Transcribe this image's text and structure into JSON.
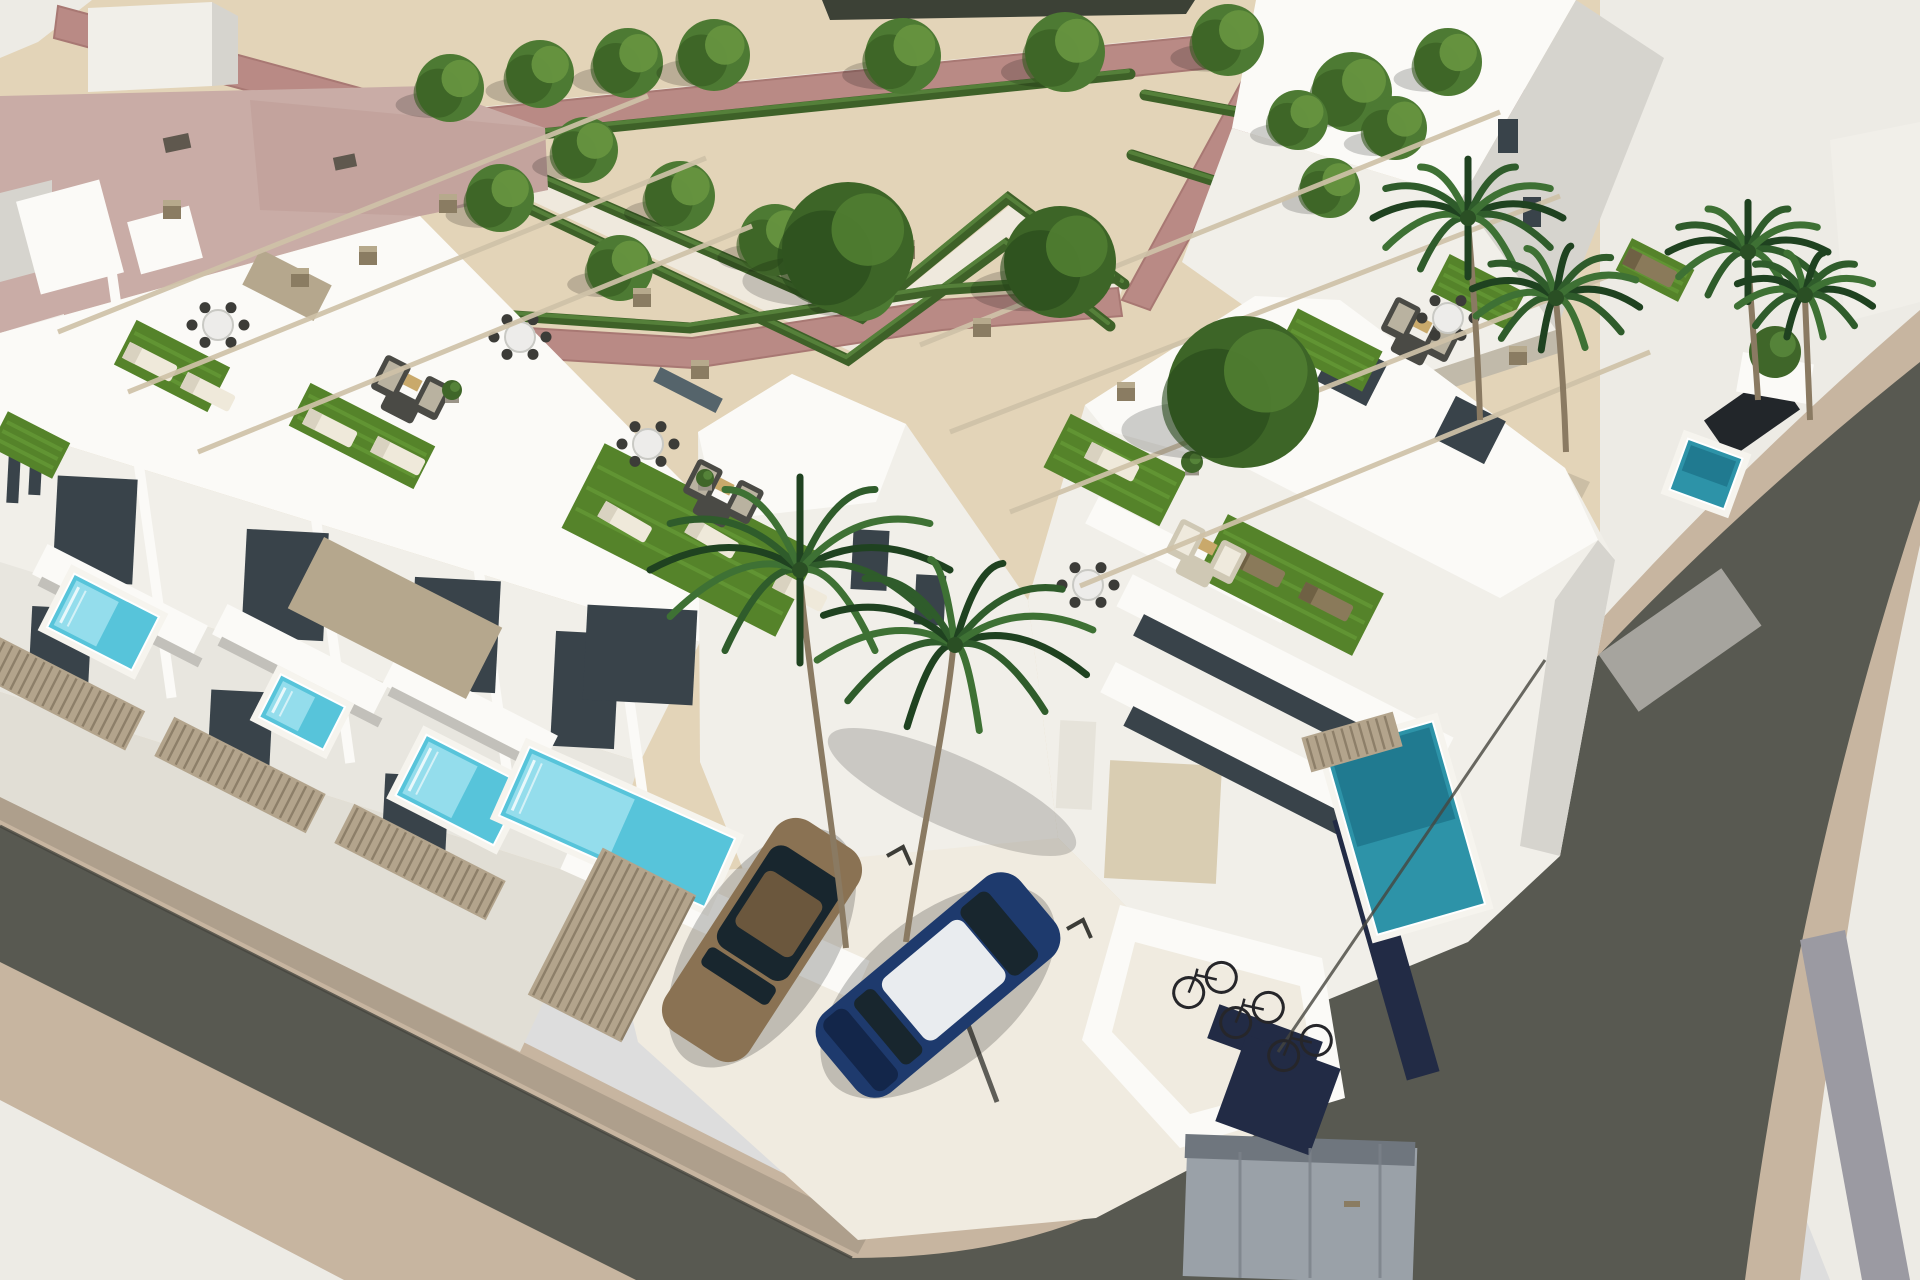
{
  "image": {
    "type": "3d-architectural-render",
    "subject": "aerial view of modern white terraced houses with rooftop terraces, private plunge pools, pergolas, a formal hedge park, corner streets, parked cars, palms and a bicycle shelter"
  },
  "palette": {
    "sand": "#e3d4b8",
    "pavement": "#edebe5",
    "pavement_warm": "#f0ebe0",
    "tan": "#c7b5a0",
    "asphalt": "#585951",
    "mauve": "#b98a85",
    "mauve2": "#a87873",
    "hedge": "#3e6128",
    "hedge_hi": "#55803a",
    "walk": "#efe9dd",
    "white_wall": "#f1efe9",
    "white_bright": "#fbfaf7",
    "band3": "#e8e6df",
    "band4": "#e1ded5",
    "wall_shade": "#d6d4ce",
    "wall_mid": "#c2c0ba",
    "wall_dark": "#a6a49e",
    "glass": "#39434a",
    "glass2": "#55646b",
    "stone": "#b5a78d",
    "beam": "#cfc2a8",
    "cap": "#8a7c62",
    "cap_top": "#b6a98c",
    "fence": "#b3a48c",
    "fence_slat": "#8d7f69",
    "turf": "#55832a",
    "turf2": "#6aa039",
    "pool_rim": "#f6f4ee",
    "pool_light": "#9fe2ee",
    "pool_mid": "#57c4da",
    "pool_teal": "#2d93a8",
    "pool_deep": "#1d7489",
    "trunk": "#8a7a62",
    "tree": "#4d7a33",
    "tree_d": "#35591f",
    "tree_l": "#66933f",
    "btree": "#3d6527",
    "btree_d": "#27481a",
    "btree_l": "#4f7c30",
    "palm1": "#1f4220",
    "palm2": "#2f5c2b",
    "palm3": "#3e7134",
    "car_gold": "#8a7253",
    "car_gold2": "#6b573d",
    "car_blue": "#1e3a6d",
    "car_blue2": "#13264a",
    "car_roof": "#e9ecef",
    "car_glass": "#18262e",
    "car_dark": "#22262a",
    "bike": "#26262a",
    "furn": "#4a4a45",
    "furn_c": "#d9d2bf",
    "cabinet": "#9aa1a8",
    "cabinet2": "#6f767e",
    "navy": "#222b45",
    "median": "#9b9aa2",
    "distant": "#3c4136",
    "door_beige": "#d9cdb2",
    "door_white": "#e6e3da",
    "vent": "#5f584e",
    "roof_pink": "#c9aca6",
    "roof_pink2": "#bd9c95"
  },
  "park": {
    "walkways": [
      "470,108 1265,28 1272,52 478,136",
      "470,140 862,325 1010,205 1122,290 1112,318 1008,237 852,352 458,166"
    ],
    "mauve_paths": [
      "58,6 448,112 452,146 54,38",
      "448,112 1262,30 1270,62 452,146",
      "1262,30 1548,96 1540,128 1270,62",
      "1262,44 1292,52 1150,310 1122,300",
      "398,320 692,338 940,300 1118,288 1122,316 942,330 694,368 396,350"
    ],
    "hedges": [
      "M462,142 L1130,74",
      "M468,146 L862,318 L1008,198 L1124,284",
      "M452,172 L848,360 L1006,244 L1110,326",
      "M398,308 L690,328 L938,290 L1115,278",
      "M1145,95 L1445,150",
      "M1132,155 L1322,215"
    ],
    "trees": [
      [
        450,
        88,
        34
      ],
      [
        540,
        74,
        34
      ],
      [
        628,
        63,
        35
      ],
      [
        714,
        55,
        36
      ],
      [
        903,
        56,
        38
      ],
      [
        1065,
        52,
        40
      ],
      [
        1228,
        40,
        36
      ],
      [
        1352,
        92,
        40
      ],
      [
        1448,
        62,
        34
      ],
      [
        500,
        198,
        34
      ],
      [
        585,
        150,
        33
      ],
      [
        680,
        196,
        35
      ],
      [
        775,
        240,
        36
      ],
      [
        862,
        287,
        34
      ],
      [
        620,
        268,
        33
      ],
      [
        1298,
        120,
        30
      ],
      [
        1395,
        128,
        32
      ],
      [
        1330,
        188,
        30
      ]
    ],
    "big_trees": [
      [
        848,
        248,
        66
      ],
      [
        1060,
        262,
        56
      ],
      [
        1243,
        392,
        76
      ]
    ]
  },
  "palms": {
    "crowns": [
      [
        800,
        570,
        150,
        0
      ],
      [
        955,
        645,
        140,
        20
      ],
      [
        1468,
        218,
        95,
        0
      ],
      [
        1556,
        298,
        85,
        10
      ],
      [
        1748,
        252,
        80,
        0
      ],
      [
        1805,
        295,
        70,
        15
      ]
    ],
    "trunks": [
      "M846,948 C838,860 812,700 800,578",
      "M906,942 C920,840 945,730 953,650",
      "M1480,420 C1478,350 1472,270 1468,222",
      "M1566,452 C1564,390 1560,340 1556,300",
      "M1758,400 C1755,350 1750,295 1748,255",
      "M1810,420 C1808,370 1806,330 1805,298"
    ]
  },
  "block": {
    "pools": [
      [
        103,
        622,
        95,
        60,
        27,
        "light"
      ],
      [
        302,
        712,
        72,
        48,
        27,
        "light"
      ],
      [
        460,
        790,
        110,
        68,
        27,
        "light"
      ],
      [
        617,
        827,
        225,
        75,
        24,
        "light"
      ],
      [
        1405,
        828,
        112,
        190,
        -16,
        "teal"
      ],
      [
        1706,
        474,
        58,
        54,
        20,
        "teal"
      ]
    ],
    "turf": [
      [
        172,
        366,
        105,
        50,
        27
      ],
      [
        362,
        436,
        140,
        48,
        27
      ],
      [
        690,
        540,
        240,
        95,
        27
      ],
      [
        1115,
        470,
        130,
        60,
        27
      ],
      [
        1290,
        585,
        175,
        70,
        27
      ],
      [
        1330,
        350,
        95,
        45,
        27
      ],
      [
        1478,
        292,
        85,
        42,
        27
      ],
      [
        30,
        445,
        70,
        40,
        27
      ],
      [
        1655,
        270,
        70,
        36,
        27
      ]
    ],
    "fences": [
      [
        55,
        690,
        180,
        44,
        27
      ],
      [
        240,
        775,
        170,
        44,
        27
      ],
      [
        420,
        862,
        170,
        44,
        27
      ],
      [
        612,
        945,
        105,
        165,
        27
      ],
      [
        1352,
        742,
        95,
        36,
        -16
      ]
    ],
    "beams": [
      [
        58,
        332,
        648,
        96
      ],
      [
        128,
        392,
        706,
        158
      ],
      [
        198,
        452,
        752,
        226
      ],
      [
        920,
        345,
        1500,
        112
      ],
      [
        950,
        432,
        1560,
        196
      ],
      [
        1010,
        512,
        1608,
        276
      ],
      [
        1080,
        586,
        1650,
        352
      ]
    ],
    "posts": [
      [
        172,
        212
      ],
      [
        300,
        280
      ],
      [
        368,
        258
      ],
      [
        448,
        206
      ],
      [
        642,
        300
      ],
      [
        700,
        372
      ],
      [
        906,
        252
      ],
      [
        982,
        330
      ],
      [
        1126,
        394
      ],
      [
        1518,
        358
      ]
    ],
    "loungers": [
      [
        150,
        362,
        27,
        "white"
      ],
      [
        208,
        392,
        27,
        "white"
      ],
      [
        330,
        428,
        27,
        "white"
      ],
      [
        398,
        456,
        27,
        "white"
      ],
      [
        625,
        522,
        30,
        "white"
      ],
      [
        712,
        538,
        30,
        "white"
      ],
      [
        800,
        592,
        27,
        "white"
      ],
      [
        1258,
        568,
        27,
        "wood"
      ],
      [
        1326,
        602,
        27,
        "wood"
      ],
      [
        1112,
        462,
        27,
        "white"
      ],
      [
        1650,
        268,
        27,
        "wood"
      ]
    ],
    "sofas": [
      [
        410,
        388,
        27,
        "dark"
      ],
      [
        722,
        492,
        27,
        "dark"
      ],
      [
        1205,
        552,
        27,
        "beige"
      ],
      [
        1420,
        330,
        27,
        "dark"
      ]
    ],
    "dining": [
      [
        218,
        325
      ],
      [
        520,
        337
      ],
      [
        648,
        444
      ],
      [
        1088,
        585
      ],
      [
        1448,
        318
      ]
    ],
    "planters": [
      [
        452,
        390,
        10
      ],
      [
        705,
        478,
        9
      ],
      [
        1192,
        462,
        11
      ],
      [
        1775,
        352,
        26
      ]
    ],
    "parking_marks": [
      [
        903,
        852
      ],
      [
        993,
        888
      ],
      [
        1083,
        925
      ]
    ],
    "bikes": [
      [
        1205,
        985,
        -25
      ],
      [
        1252,
        1015,
        -25
      ],
      [
        1300,
        1048,
        -25
      ]
    ],
    "lines": [
      [
        1240,
        1152,
        1240,
        1278,
        3,
        "#7b828a"
      ],
      [
        1310,
        1148,
        1310,
        1278,
        3,
        "#7b828a"
      ],
      [
        1380,
        1144,
        1380,
        1278,
        3,
        "#7b828a"
      ],
      [
        967,
        1022,
        997,
        1102,
        5,
        "#3a3a35"
      ],
      [
        0,
        826,
        852,
        1258,
        3,
        "#46463f"
      ],
      [
        1278,
        1052,
        1545,
        660,
        3,
        "#46463f"
      ]
    ],
    "quads": [
      [
        "roof-vent",
        "vent",
        177,
        143,
        26,
        15,
        -12
      ],
      [
        "roof-vent",
        "vent",
        345,
        162,
        22,
        13,
        -12
      ],
      [
        "stair-tower",
        "white_bright",
        70,
        237,
        86,
        96,
        -15
      ],
      [
        "stair-tower",
        "white_bright",
        165,
        240,
        64,
        54,
        -15
      ],
      [
        "window",
        "glass",
        14,
        470,
        12,
        66,
        3
      ],
      [
        "window",
        "glass",
        36,
        462,
        12,
        66,
        3
      ],
      [
        "window",
        "glass",
        1508,
        136,
        20,
        34,
        0
      ],
      [
        "window",
        "glass",
        1532,
        212,
        18,
        30,
        0
      ],
      [
        "party-wall",
        "white_bright",
        141,
        480,
        10,
        440,
        -8
      ],
      [
        "party-wall",
        "white_bright",
        321,
        555,
        10,
        420,
        -8
      ],
      [
        "party-wall",
        "white_bright",
        486,
        622,
        10,
        390,
        -8
      ],
      [
        "party-wall",
        "white_bright",
        627,
        683,
        10,
        380,
        -8
      ],
      [
        "glass-door",
        "glass",
        95,
        530,
        80,
        105,
        3
      ],
      [
        "glass-door",
        "glass",
        285,
        585,
        82,
        108,
        3
      ],
      [
        "glass-door",
        "glass",
        455,
        635,
        86,
        112,
        3
      ],
      [
        "glass-door",
        "glass",
        585,
        690,
        64,
        115,
        3
      ],
      [
        "balcony",
        "white_bright",
        120,
        600,
        180,
        34,
        27
      ],
      [
        "balcony-shadow",
        "wall_mid",
        120,
        622,
        180,
        10,
        27
      ],
      [
        "balcony",
        "white_bright",
        300,
        660,
        180,
        34,
        27
      ],
      [
        "balcony-shadow",
        "wall_mid",
        300,
        682,
        180,
        10,
        27
      ],
      [
        "balcony",
        "white_bright",
        470,
        710,
        180,
        34,
        27
      ],
      [
        "balcony-shadow",
        "wall_mid",
        470,
        732,
        180,
        10,
        27
      ],
      [
        "glass-door",
        "glass",
        60,
        650,
        60,
        85,
        3
      ],
      [
        "glass-door",
        "glass",
        240,
        735,
        62,
        88,
        3
      ],
      [
        "glass-door",
        "glass",
        415,
        820,
        64,
        90,
        3
      ],
      [
        "stone-panel",
        "stone",
        287,
        285,
        80,
        40,
        27
      ],
      [
        "stone-panel",
        "stone",
        395,
        618,
        200,
        80,
        27
      ],
      [
        "counter",
        "glass2",
        688,
        390,
        70,
        16,
        27
      ],
      [
        "glass-door",
        "glass",
        640,
        655,
        110,
        95,
        3
      ],
      [
        "window",
        "glass",
        870,
        560,
        36,
        60,
        3
      ],
      [
        "window",
        "glass",
        930,
        600,
        30,
        50,
        3
      ],
      [
        "patio-wall",
        "white_bright",
        715,
        915,
        320,
        42,
        24
      ],
      [
        "garage-door",
        "door_beige",
        1163,
        822,
        112,
        118,
        3
      ],
      [
        "door",
        "door_white",
        1076,
        765,
        36,
        88,
        3
      ],
      [
        "terrace-slab",
        "white_bright",
        1285,
        672,
        360,
        36,
        27
      ],
      [
        "glass-band",
        "glass",
        1290,
        702,
        340,
        24,
        27
      ],
      [
        "terrace-slab",
        "white_bright",
        1255,
        752,
        330,
        34,
        27
      ],
      [
        "glass-band",
        "glass",
        1262,
        784,
        300,
        22,
        27
      ],
      [
        "terrace-slab",
        "white_bright",
        1190,
        560,
        220,
        30,
        27
      ],
      [
        "window",
        "glass",
        1352,
        372,
        56,
        48,
        27
      ],
      [
        "window",
        "glass",
        1470,
        430,
        56,
        48,
        27
      ],
      [
        "fence-dark",
        "navy",
        1386,
        946,
        34,
        270,
        -16
      ],
      [
        "roof-wedge",
        "wall_dark",
        1680,
        640,
        150,
        70,
        -35
      ],
      [
        "utility-cabinet",
        "cabinet",
        1300,
        1212,
        230,
        136,
        2
      ],
      [
        "utility-cabinet-top",
        "cabinet2",
        1300,
        1150,
        230,
        24,
        2
      ],
      [
        "navy-panel",
        "navy",
        1265,
        1040,
        110,
        36,
        20
      ],
      [
        "navy-panel",
        "navy",
        1278,
        1095,
        100,
        92,
        20
      ],
      [
        "cabinet-handle",
        "cap",
        1352,
        1204,
        16,
        6,
        0
      ],
      [
        "parked-car",
        "car_dark",
        1752,
        415,
        46,
        85,
        55
      ],
      [
        "planter-box",
        "white_bright",
        1775,
        378,
        72,
        40,
        10
      ]
    ]
  }
}
